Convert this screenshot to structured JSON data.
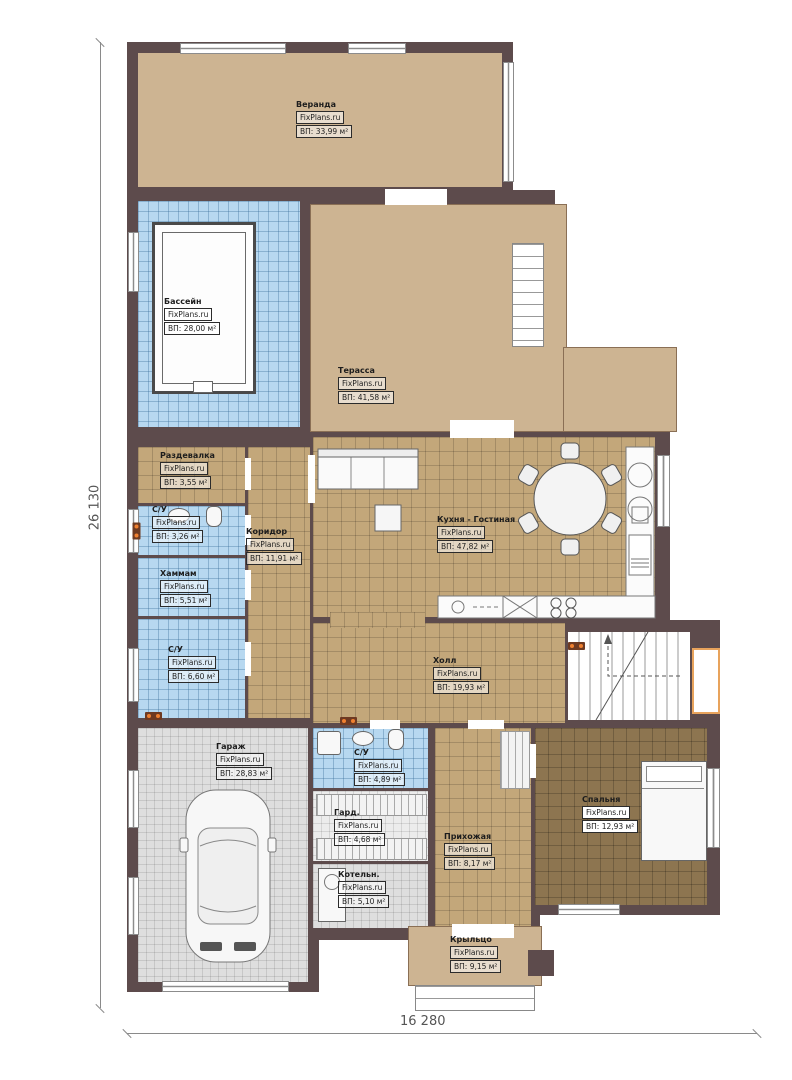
{
  "title": "План первого этажа",
  "watermark": "FixPlans.ru",
  "dimensions": {
    "left": "26 130",
    "bottom": "16 280"
  },
  "rooms": [
    {
      "id": "veranda",
      "name": "Веранда",
      "area": "ВП: 33,99 м²"
    },
    {
      "id": "pool",
      "name": "Бассейн",
      "area": "ВП: 28,00 м²"
    },
    {
      "id": "terrace",
      "name": "Терасса",
      "area": "ВП: 41,58 м²"
    },
    {
      "id": "changing",
      "name": "Раздевалка",
      "area": "ВП: 3,55 м²"
    },
    {
      "id": "wc1",
      "name": "С/У",
      "area": "ВП: 3,26 м²"
    },
    {
      "id": "corridor",
      "name": "Коридор",
      "area": "ВП: 11,91 м²"
    },
    {
      "id": "hammam",
      "name": "Хаммам",
      "area": "ВП: 5,51 м²"
    },
    {
      "id": "wc2",
      "name": "С/У",
      "area": "ВП: 6,60 м²"
    },
    {
      "id": "kitchen",
      "name": "Кухня - Гостиная",
      "area": "ВП:    47,82 м²"
    },
    {
      "id": "hall",
      "name": "Холл",
      "area": "ВП: 19,93 м²"
    },
    {
      "id": "garage",
      "name": "Гараж",
      "area": "ВП: 28,83 м²"
    },
    {
      "id": "wc3",
      "name": "С/У",
      "area": "ВП: 4,89 м²"
    },
    {
      "id": "wardrobe",
      "name": "Гард.",
      "area": "ВП: 4,68 м²"
    },
    {
      "id": "boiler",
      "name": "Котельн.",
      "area": "ВП: 5,10 м²"
    },
    {
      "id": "entry",
      "name": "Прихожая",
      "area": "ВП: 8,17 м²"
    },
    {
      "id": "bedroom",
      "name": "Спальня",
      "area": "ВП: 12,93 м²"
    },
    {
      "id": "porch",
      "name": "Крыльцо",
      "area": "ВП: 9,15 м²"
    }
  ],
  "colors": {
    "wall": "#5d4b4c",
    "tan": "#cdb492",
    "tanTile": "#c3a77a",
    "blueTile": "#b7d8f0",
    "grayTile": "#dedede",
    "darkTile": "#8d7550"
  }
}
